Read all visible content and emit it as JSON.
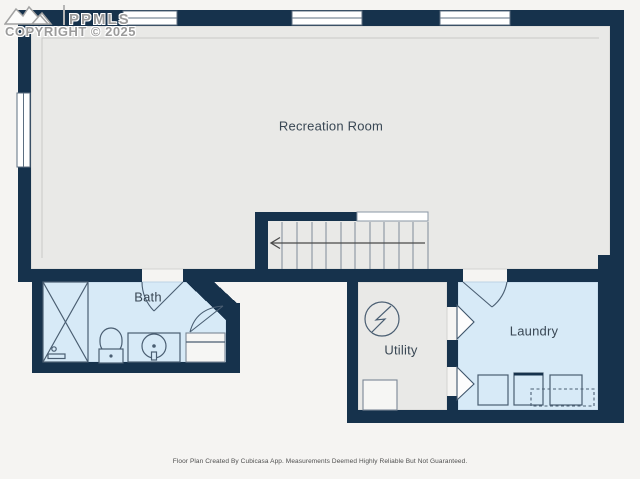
{
  "watermark": {
    "logo_icon": "mountain-peaks-icon",
    "brand": "PPMLS",
    "copyright": "COPYRIGHT © 2025"
  },
  "rooms": {
    "recreation": {
      "label": "Recreation Room",
      "fill": "gray"
    },
    "bath": {
      "label": "Bath",
      "fill": "blue"
    },
    "utility": {
      "label": "Utility",
      "fill": "gray"
    },
    "laundry": {
      "label": "Laundry",
      "fill": "blue"
    }
  },
  "fixtures": {
    "stairs": "staircase-with-down-arrow",
    "bath": [
      "shower-stall",
      "toilet",
      "sink-vanity",
      "cabinet"
    ],
    "utility": [
      "electrical-panel-icon",
      "water-heater"
    ],
    "laundry": [
      "appliance-square-1",
      "appliance-square-2",
      "appliance-square-3",
      "appliance-dashed-outline"
    ]
  },
  "footer": {
    "disclaimer": "Floor Plan Created By Cubicasa App. Measurements Deemed Highly Reliable But Not Guaranteed."
  },
  "colors": {
    "wall": "#16324c",
    "room_gray": "#e9e9e7",
    "room_blue": "#d7eaf7",
    "bg": "#f5f4f2",
    "label": "#394754",
    "watermark": "#9b9b9b",
    "footer_text": "#4f4f4f"
  }
}
